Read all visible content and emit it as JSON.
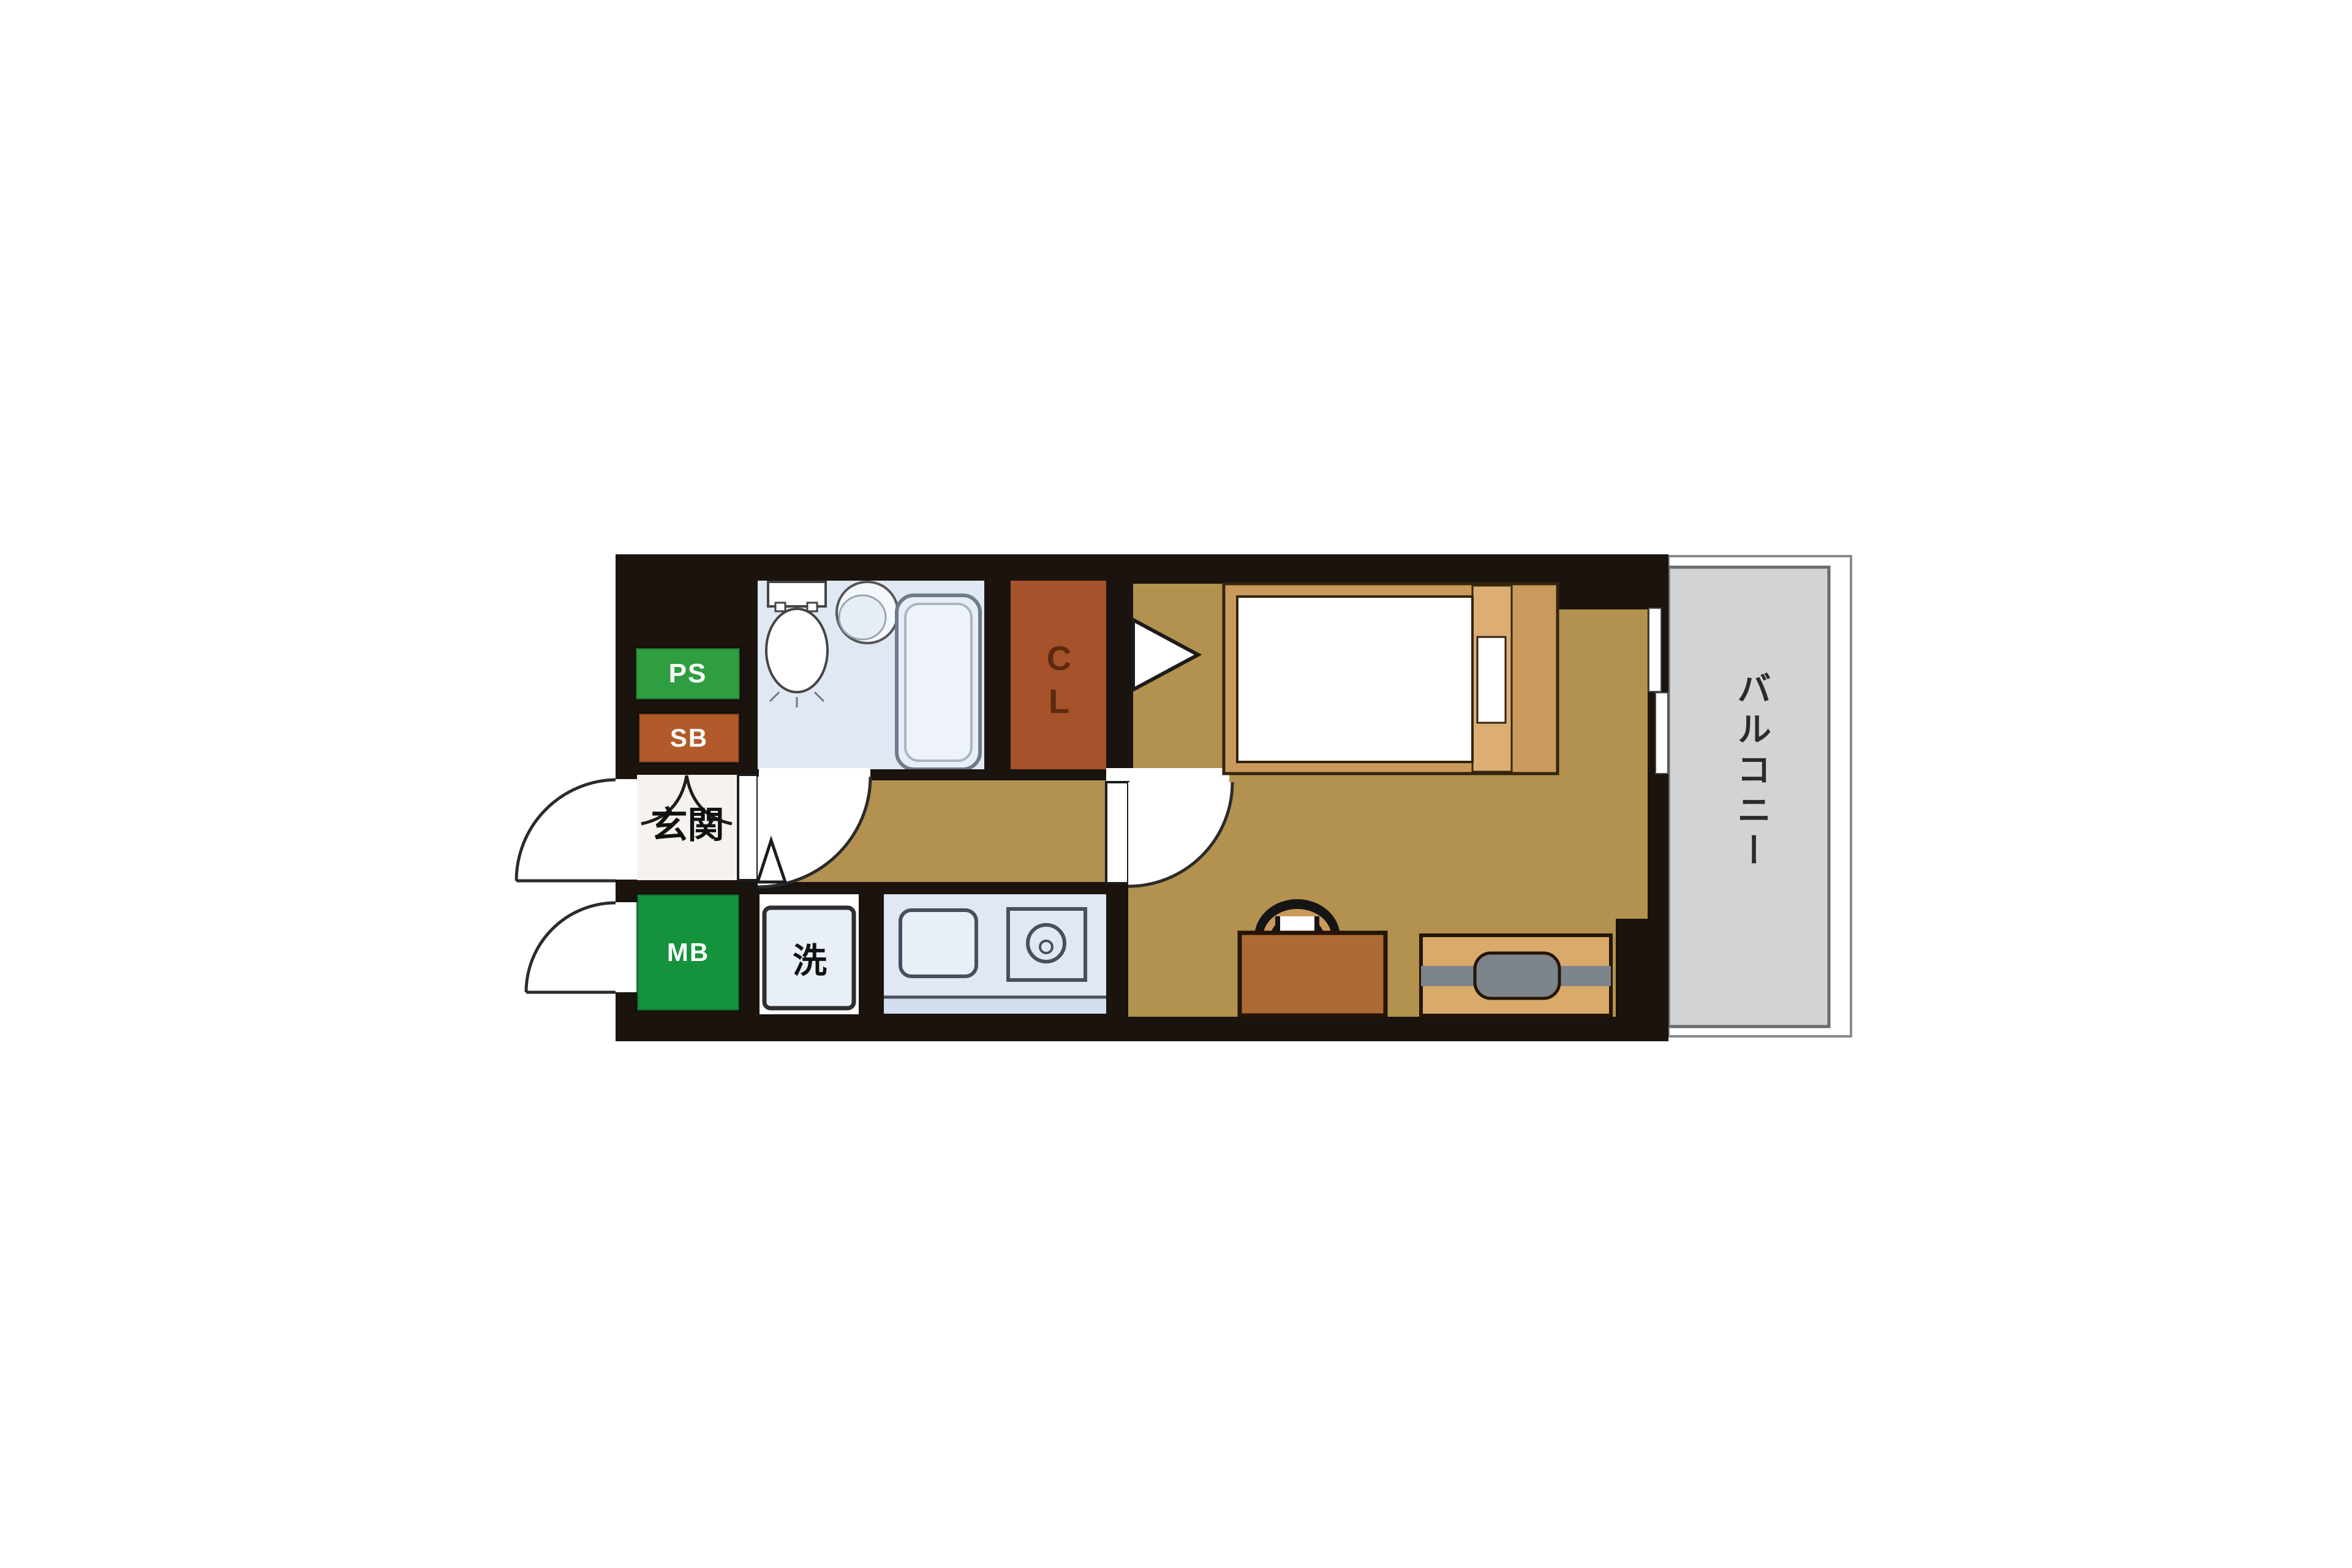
{
  "plan": {
    "type": "japanese-apartment-floor-plan",
    "rooms": {
      "balcony_label": "バルコニー",
      "entrance_label": "玄関",
      "closet_label": "C\nL",
      "pipe_space_label": "PS",
      "shoe_box_label": "SB",
      "meter_box_label": "MB",
      "laundry_label": "洗"
    },
    "colors": {
      "wall_black": "#1a130e",
      "floor_tan": "#b3914f",
      "bathroom_blue": "#dfe8f3",
      "kitchen_blue": "#dfe8f3",
      "kitchen_counter_edge": "#d3dfee",
      "closet_brown": "#a6522a",
      "shoe_box_brown": "#b25a2a",
      "pipe_space_green": "#2f9e41",
      "meter_box_green": "#14923c",
      "balcony_gray": "#d3d3d3",
      "genkan_white": "#f6f3ee",
      "bed_frame_tan": "#c99a5c",
      "bed_headboard_tan": "#dcae73",
      "desk_brown": "#ad6a33",
      "tv_board_tan": "#d9aa69",
      "tv_gray": "#7d848b",
      "fixture_white": "#ffffff",
      "laundry_box_blue": "#e9eff7"
    }
  }
}
